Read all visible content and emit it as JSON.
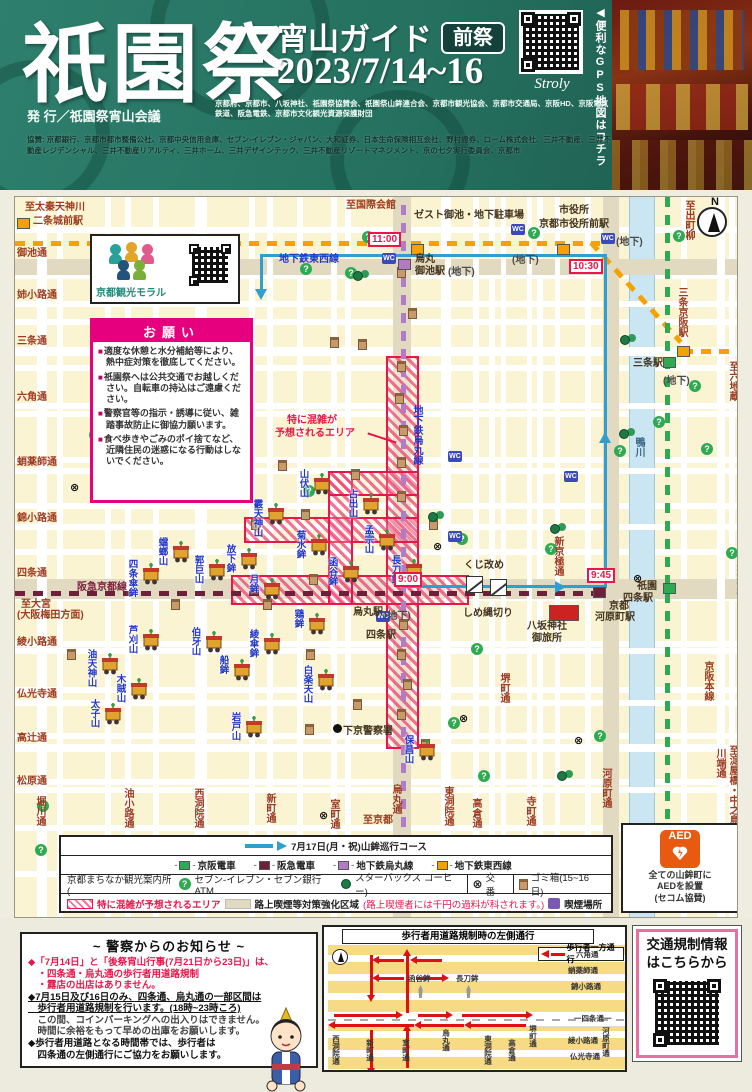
{
  "header": {
    "title": "祇園祭",
    "subtitle": "宵山ガイド",
    "badge": "前祭",
    "dates": "2023/7/14~16",
    "qr_label": "Stroly",
    "gps_note": "◀便利なGPS地図はコチラ",
    "publisher": "発 行／祇園祭宵山会議",
    "credits1": "京都府、京都市、八坂神社、祇園祭協賛会、祇園祭山鉾連合会、京都市観光協会、京都市交通局、京阪HD、京阪電気鉄道、阪急電鉄、京都市文化観光資源保護財団",
    "credits2": "協賛: 京都銀行、京都市都市整備公社、京都中央信用金庫、セブン-イレブン・ジャパン、大和証券、日本生命保険相互会社、野村證券、ローム株式会社、三井不動産、三井不動産レジデンシャル、三井不動産リアルティ、三井ホーム、三井デザインテック、三井不動産リゾートマネジメント、京の七夕実行委員会、京都市"
  },
  "map": {
    "compass": "N",
    "morals": {
      "label": "京都観光モラル"
    },
    "request": {
      "title": "お願い",
      "items": [
        "適度な休憩と水分補給等により、熱中症対策を徹底してください。",
        "祇園祭へは公共交通でお越しください。自転車の持込はご遠慮ください。",
        "警察官等の指示・誘導に従い、雑踏事故防止に御協力願います。",
        "食べ歩きやごみのポイ捨てなど、近隣住民の迷惑になる行動はしないでください。"
      ]
    },
    "h_streets": [
      {
        "name": "御池通",
        "y": 62,
        "bh": 16,
        "beige": true
      },
      {
        "name": "姉小路通",
        "y": 104,
        "bh": 6,
        "beige": false
      },
      {
        "name": "三条通",
        "y": 150,
        "bh": 9,
        "beige": false
      },
      {
        "name": "六角通",
        "y": 206,
        "bh": 6,
        "beige": false
      },
      {
        "name": "蛸薬師通",
        "y": 271,
        "bh": 6,
        "beige": false
      },
      {
        "name": "錦小路通",
        "y": 327,
        "bh": 6,
        "beige": false
      },
      {
        "name": "四条通",
        "y": 382,
        "bh": 20,
        "beige": true
      },
      {
        "name": "綾小路通",
        "y": 451,
        "bh": 6,
        "beige": false
      },
      {
        "name": "仏光寺通",
        "y": 503,
        "bh": 6,
        "beige": false
      },
      {
        "name": "高辻通",
        "y": 547,
        "bh": 8,
        "beige": false
      },
      {
        "name": "松原通",
        "y": 590,
        "bh": 6,
        "beige": false
      }
    ],
    "v_streets": [
      {
        "name": "堀川通",
        "x": 22,
        "bw": 10,
        "ly": 599,
        "beige": false
      },
      {
        "name": "油小路通",
        "x": 110,
        "bw": 6,
        "ly": 591,
        "beige": false
      },
      {
        "name": "西洞院通",
        "x": 180,
        "bw": 6,
        "ly": 591,
        "beige": false
      },
      {
        "name": "新町通",
        "x": 252,
        "bw": 6,
        "ly": 596,
        "beige": false
      },
      {
        "name": "室町通",
        "x": 316,
        "bw": 6,
        "ly": 602,
        "beige": false
      },
      {
        "name": "烏丸通",
        "x": 378,
        "bw": 18,
        "ly": 587,
        "beige": true
      },
      {
        "name": "東洞院通",
        "x": 430,
        "bw": 6,
        "ly": 589,
        "beige": false
      },
      {
        "name": "高倉通",
        "x": 458,
        "bw": 6,
        "ly": 601,
        "beige": false
      },
      {
        "name": "堺町通",
        "x": 486,
        "bw": 5,
        "ly": 476,
        "beige": false
      },
      {
        "name": "寺町通",
        "x": 512,
        "bw": 5,
        "ly": 599,
        "beige": false
      },
      {
        "name": "新京極通",
        "x": 540,
        "bw": 5,
        "ly": 339,
        "beige": false
      },
      {
        "name": "河原町通",
        "x": 588,
        "bw": 16,
        "ly": 571,
        "beige": true
      },
      {
        "name": "川端通",
        "x": 702,
        "bw": 8,
        "ly": 551,
        "beige": false
      }
    ],
    "places": [
      {
        "t": "至太秦天神川",
        "x": 10,
        "y": 5,
        "c": "r"
      },
      {
        "t": "二条城前駅",
        "x": 18,
        "y": 19,
        "c": "r"
      },
      {
        "t": "至国際会館",
        "x": 331,
        "y": 3,
        "c": "r"
      },
      {
        "t": "ゼスト御池・地下駐車場",
        "x": 399,
        "y": 13,
        "c": "d"
      },
      {
        "t": "市役所",
        "x": 544,
        "y": 8,
        "c": "d"
      },
      {
        "t": "京都市役所前駅",
        "x": 524,
        "y": 22,
        "c": "d"
      },
      {
        "t": "至出町柳",
        "x": 668,
        "y": 3,
        "c": "r",
        "v": true
      },
      {
        "t": "三条京阪駅",
        "x": 661,
        "y": 90,
        "c": "r",
        "v": true
      },
      {
        "t": "至六地蔵",
        "x": 712,
        "y": 164,
        "c": "r",
        "v": true
      },
      {
        "t": "三条駅",
        "x": 618,
        "y": 161,
        "c": "d"
      },
      {
        "t": "(地下)",
        "x": 648,
        "y": 179,
        "c": "g"
      },
      {
        "t": "鴨川",
        "x": 618,
        "y": 240,
        "c": "riv",
        "v": true
      },
      {
        "t": "八坂神社",
        "x": 719,
        "y": 360,
        "c": "r",
        "v": true
      },
      {
        "t": "祇園",
        "x": 622,
        "y": 384,
        "c": "d"
      },
      {
        "t": "四条駅",
        "x": 608,
        "y": 396,
        "c": "d"
      },
      {
        "t": "京都",
        "x": 594,
        "y": 404,
        "c": "d"
      },
      {
        "t": "河原町駅",
        "x": 580,
        "y": 415,
        "c": "d"
      },
      {
        "t": "京阪本線",
        "x": 687,
        "y": 464,
        "c": "r",
        "v": true
      },
      {
        "t": "至淀屋橋・中之島",
        "x": 712,
        "y": 548,
        "c": "r",
        "v": true
      },
      {
        "t": "地下鉄東西線",
        "x": 264,
        "y": 57,
        "c": "b"
      },
      {
        "t": "地下鉄烏丸線",
        "x": 396,
        "y": 208,
        "c": "b",
        "v": true
      },
      {
        "t": "阪急京都線",
        "x": 62,
        "y": 385,
        "c": "m"
      },
      {
        "t": "至大宮",
        "x": 6,
        "y": 402,
        "c": "r"
      },
      {
        "t": "(大阪梅田方面)",
        "x": 2,
        "y": 413,
        "c": "r"
      },
      {
        "t": "烏丸駅",
        "x": 338,
        "y": 410,
        "c": "d"
      },
      {
        "t": "四条駅",
        "x": 351,
        "y": 433,
        "c": "d"
      },
      {
        "t": "烏丸",
        "x": 400,
        "y": 57,
        "c": "d"
      },
      {
        "t": "御池駅",
        "x": 400,
        "y": 69,
        "c": "d"
      },
      {
        "t": "くじ改め",
        "x": 449,
        "y": 363,
        "c": "d"
      },
      {
        "t": "しめ縄切り",
        "x": 448,
        "y": 411,
        "c": "d"
      },
      {
        "t": "八坂神社",
        "x": 512,
        "y": 424,
        "c": "d"
      },
      {
        "t": "御旅所",
        "x": 517,
        "y": 436,
        "c": "d"
      },
      {
        "t": "下京警察署",
        "x": 328,
        "y": 529,
        "c": "d"
      },
      {
        "t": "至京都",
        "x": 348,
        "y": 618,
        "c": "r"
      },
      {
        "t": "(地下)",
        "x": 433,
        "y": 70,
        "c": "g"
      },
      {
        "t": "(地下)",
        "x": 497,
        "y": 58,
        "c": "g"
      },
      {
        "t": "(地下)",
        "x": 601,
        "y": 40,
        "c": "g"
      },
      {
        "t": "(地下)",
        "x": 369,
        "y": 414,
        "c": "g"
      },
      {
        "t": "特に混雑が",
        "x": 272,
        "y": 218,
        "c": "red2"
      },
      {
        "t": "予想されるエリア",
        "x": 260,
        "y": 231,
        "c": "red2"
      }
    ],
    "floats": [
      {
        "n": "山伏山",
        "x": 295,
        "y": 276
      },
      {
        "n": "霰天神山",
        "x": 249,
        "y": 306
      },
      {
        "n": "占出山",
        "x": 344,
        "y": 296
      },
      {
        "n": "菊水鉾",
        "x": 292,
        "y": 337
      },
      {
        "n": "放下鉾",
        "x": 222,
        "y": 351
      },
      {
        "n": "月鉾",
        "x": 245,
        "y": 381
      },
      {
        "n": "函谷鉾",
        "x": 324,
        "y": 364
      },
      {
        "n": "孟宗山",
        "x": 360,
        "y": 332
      },
      {
        "n": "長刀鉾",
        "x": 387,
        "y": 362
      },
      {
        "n": "四条傘鉾",
        "x": 124,
        "y": 366
      },
      {
        "n": "蟷螂山",
        "x": 154,
        "y": 344
      },
      {
        "n": "郭巨山",
        "x": 190,
        "y": 362
      },
      {
        "n": "芦刈山",
        "x": 124,
        "y": 432
      },
      {
        "n": "伯牙山",
        "x": 187,
        "y": 434
      },
      {
        "n": "綾傘鉾",
        "x": 245,
        "y": 436
      },
      {
        "n": "鶏鉾",
        "x": 290,
        "y": 416
      },
      {
        "n": "船鉾",
        "x": 215,
        "y": 462
      },
      {
        "n": "白楽天山",
        "x": 299,
        "y": 472
      },
      {
        "n": "木賊山",
        "x": 112,
        "y": 481
      },
      {
        "n": "油天神山",
        "x": 83,
        "y": 456
      },
      {
        "n": "太子山",
        "x": 86,
        "y": 506
      },
      {
        "n": "岩戸山",
        "x": 227,
        "y": 519
      },
      {
        "n": "保昌山",
        "x": 400,
        "y": 542
      }
    ],
    "times": [
      {
        "t": "11:00",
        "x": 353,
        "y": 35
      },
      {
        "t": "10:30",
        "x": 554,
        "y": 62
      },
      {
        "t": "9:00",
        "x": 379,
        "y": 375
      },
      {
        "t": "9:45",
        "x": 572,
        "y": 371
      }
    ],
    "markers": [
      {
        "c": "#f5a200",
        "x": 2,
        "y": 21
      },
      {
        "c": "#f5a200",
        "x": 396,
        "y": 47
      },
      {
        "c": "#f5a200",
        "x": 542,
        "y": 47
      },
      {
        "c": "#f5a200",
        "x": 662,
        "y": 149
      },
      {
        "c": "#2faa52",
        "x": 648,
        "y": 160
      },
      {
        "c": "#2faa52",
        "x": 648,
        "y": 386
      },
      {
        "c": "#6d1f3c",
        "x": 578,
        "y": 390
      },
      {
        "c": "#b07cc6",
        "x": 383,
        "y": 62
      },
      {
        "c": "#cc2222",
        "x": 534,
        "y": 408,
        "w": 30,
        "h": 16
      }
    ],
    "icons": {
      "bins": [
        [
          382,
          70
        ],
        [
          393,
          111
        ],
        [
          315,
          140
        ],
        [
          343,
          142
        ],
        [
          263,
          263
        ],
        [
          228,
          274
        ],
        [
          106,
          287
        ],
        [
          382,
          164
        ],
        [
          380,
          196
        ],
        [
          384,
          228
        ],
        [
          382,
          260
        ],
        [
          336,
          272
        ],
        [
          236,
          322
        ],
        [
          286,
          312
        ],
        [
          382,
          294
        ],
        [
          414,
          322
        ],
        [
          384,
          422
        ],
        [
          382,
          452
        ],
        [
          388,
          482
        ],
        [
          382,
          512
        ],
        [
          248,
          402
        ],
        [
          294,
          377
        ],
        [
          156,
          402
        ],
        [
          291,
          452
        ],
        [
          338,
          502
        ],
        [
          406,
          542
        ],
        [
          52,
          452
        ],
        [
          290,
          527
        ]
      ],
      "info": [
        [
          74,
          232
        ],
        [
          285,
          66
        ],
        [
          330,
          70
        ],
        [
          347,
          34
        ],
        [
          513,
          30
        ],
        [
          658,
          33
        ],
        [
          674,
          183
        ],
        [
          638,
          219
        ],
        [
          686,
          246
        ],
        [
          599,
          248
        ],
        [
          288,
          288
        ],
        [
          441,
          336
        ],
        [
          530,
          346
        ],
        [
          711,
          350
        ],
        [
          456,
          446
        ],
        [
          579,
          533
        ],
        [
          433,
          520
        ],
        [
          463,
          573
        ],
        [
          22,
          603
        ],
        [
          20,
          647
        ]
      ],
      "sb": [
        [
          338,
          74
        ],
        [
          605,
          138
        ],
        [
          604,
          232
        ],
        [
          413,
          315
        ],
        [
          535,
          327
        ],
        [
          542,
          574
        ]
      ],
      "wc": [
        [
          367,
          56
        ],
        [
          496,
          27
        ],
        [
          586,
          36
        ],
        [
          433,
          254
        ],
        [
          433,
          334
        ],
        [
          361,
          414
        ],
        [
          549,
          274
        ]
      ],
      "kouban": [
        [
          55,
          286
        ],
        [
          418,
          345
        ],
        [
          618,
          377
        ],
        [
          444,
          517
        ],
        [
          559,
          539
        ],
        [
          304,
          614
        ]
      ]
    },
    "congestion_line1": "特に混雑が",
    "congestion_line2": "予想されるエリア"
  },
  "legend": {
    "row1": "7月17日(月・祝)山鉾巡行コース",
    "rails": [
      {
        "label": "京阪電車",
        "color": "#2faa52"
      },
      {
        "label": "阪急電車",
        "color": "#6d1f3c"
      },
      {
        "label": "地下鉄烏丸線",
        "color": "#b07cc6"
      },
      {
        "label": "地下鉄東西線",
        "color": "#f5a200"
      }
    ],
    "info_cell": "京都まちなか観光案内所 (",
    "info_711": "セブン-イレブン・セブン銀行ATM",
    "info_sb": "スターバックス コーヒー)",
    "kouban": "交番",
    "trash": "ゴミ箱(15~16日)",
    "congestion": "特に混雑が予想されるエリア",
    "smoke_zone": "路上喫煙等対策強化区域",
    "smoke_zone_red": "(路上喫煙者には千円の過料が科されます。)",
    "smoke_spot": "喫煙場所"
  },
  "aed": {
    "icon": "AED",
    "line1": "全ての山鉾町に",
    "line2": "AEDを設置",
    "line3": "(セコム協賛)"
  },
  "police": {
    "title": "~ 警察からのお知らせ ~",
    "items": [
      {
        "t": "◆「7月14日」と「後祭宵山行事(7月21日から23日)」は、",
        "s": "p-red"
      },
      {
        "t": "　・四条通・烏丸通の歩行者用道路規制",
        "s": "p-red"
      },
      {
        "t": "　・露店の出店はありません。",
        "s": "p-red"
      },
      {
        "t": "◆7月15日及び16日のみ、四条通、烏丸通の一部区間は",
        "s": "p-black"
      },
      {
        "t": "　歩行者用道路規制を行います。(18時~23時ころ)",
        "s": "p-black"
      },
      {
        "t": "　この間、コインパーキングへの出入りはできません。",
        "s": "p-gray"
      },
      {
        "t": "　時間に余裕をもって早めの出庫をお願いします。",
        "s": "p-gray"
      },
      {
        "t": "◆歩行者用道路となる時間帯では、歩行者は",
        "s": "p-bold"
      },
      {
        "t": "　四条通の左側通行にご協力をお願いします。",
        "s": "p-bold"
      }
    ]
  },
  "diagram": {
    "title": "歩行者用道路規制時の左側通行",
    "legend": "歩行者一方通行",
    "labels": [
      {
        "t": "六角通",
        "x": 252,
        "y": 24
      },
      {
        "t": "蛸薬師通",
        "x": 244,
        "y": 40
      },
      {
        "t": "錦小路通",
        "x": 247,
        "y": 56
      },
      {
        "t": "函谷鉾",
        "x": 84,
        "y": 48
      },
      {
        "t": "長刀鉾",
        "x": 132,
        "y": 48
      },
      {
        "t": "一四条通一",
        "x": 250,
        "y": 88
      },
      {
        "t": "綾小路通",
        "x": 244,
        "y": 110
      },
      {
        "t": "仏光寺通",
        "x": 246,
        "y": 126
      },
      {
        "t": "河原町通",
        "x": 278,
        "y": 100,
        "v": true
      },
      {
        "t": "堺町通",
        "x": 205,
        "y": 98,
        "v": true
      },
      {
        "t": "西洞院通",
        "x": 8,
        "y": 108,
        "v": true
      },
      {
        "t": "新町通",
        "x": 42,
        "y": 112,
        "v": true
      },
      {
        "t": "室町通",
        "x": 78,
        "y": 112,
        "v": true
      },
      {
        "t": "烏丸通",
        "x": 118,
        "y": 102,
        "v": true
      },
      {
        "t": "東洞院通",
        "x": 160,
        "y": 108,
        "v": true
      },
      {
        "t": "高倉通",
        "x": 184,
        "y": 112,
        "v": true
      }
    ],
    "arrows": [
      {
        "x": 82,
        "y": 28,
        "l": 58,
        "d": "u"
      },
      {
        "x": 46,
        "y": 28,
        "l": 40,
        "d": "d"
      },
      {
        "x": 54,
        "y": 32,
        "l": 26,
        "d": "l"
      },
      {
        "x": 92,
        "y": 32,
        "l": 26,
        "d": "l"
      },
      {
        "x": 54,
        "y": 50,
        "l": 26,
        "d": "l"
      },
      {
        "x": 92,
        "y": 50,
        "l": 26,
        "d": "r"
      },
      {
        "x": 10,
        "y": 87,
        "l": 62,
        "d": "r"
      },
      {
        "x": 94,
        "y": 87,
        "l": 28,
        "d": "r"
      },
      {
        "x": 138,
        "y": 87,
        "l": 64,
        "d": "r"
      },
      {
        "x": 10,
        "y": 97,
        "l": 80,
        "d": "l"
      },
      {
        "x": 96,
        "y": 97,
        "l": 44,
        "d": "l"
      },
      {
        "x": 146,
        "y": 97,
        "l": 56,
        "d": "l"
      },
      {
        "x": 46,
        "y": 103,
        "l": 38,
        "d": "d"
      },
      {
        "x": 82,
        "y": 103,
        "l": 38,
        "d": "u"
      }
    ]
  },
  "traffic": {
    "line1": "交通規制情報",
    "line2": "はこちらから"
  }
}
